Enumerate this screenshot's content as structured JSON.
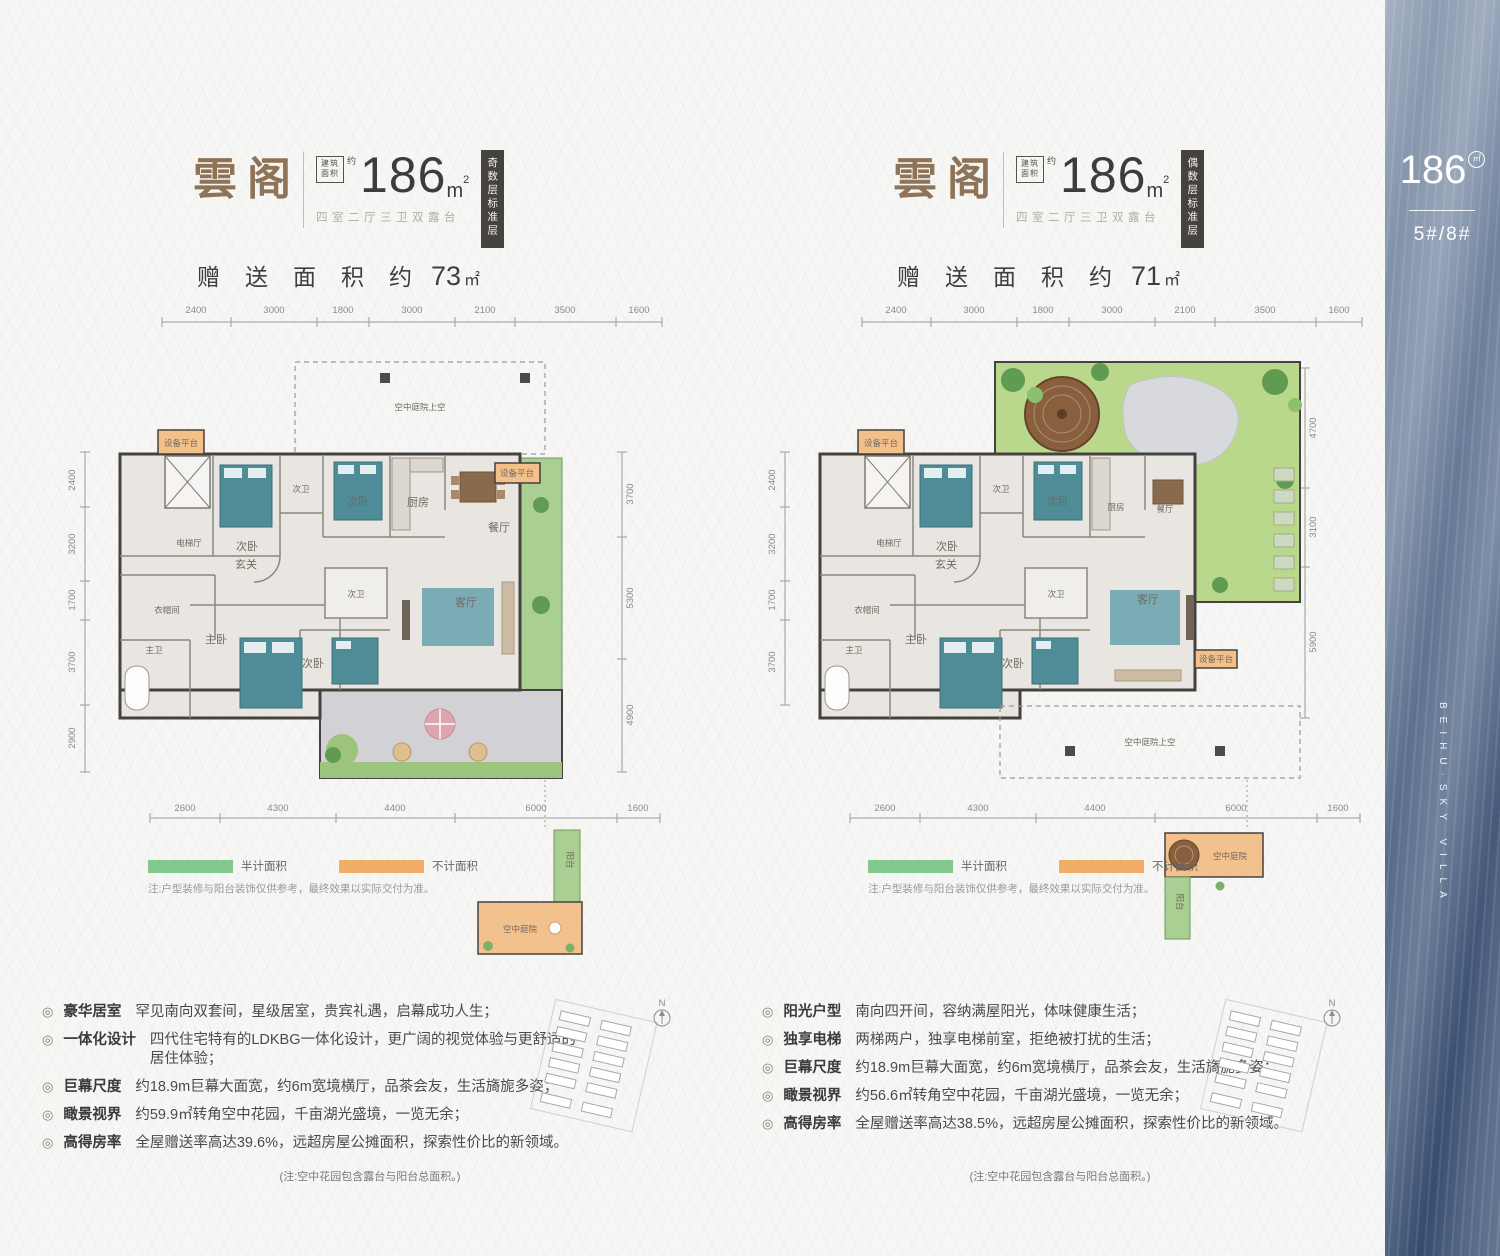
{
  "colors": {
    "title_brown": "#8f7356",
    "badge_dark": "#46423d",
    "legend_green": "#82c98f",
    "legend_orange": "#f2ae67",
    "plan_green": "#aacf92",
    "plan_orange": "#f4c089",
    "bed_teal": "#4e8d98",
    "sidebar_blue": "#6d809d"
  },
  "left": {
    "header": {
      "title": "雲阁",
      "area_box": "建筑面积",
      "approx": "约",
      "area": "186",
      "area_unit_m": "m",
      "area_sup": "2",
      "subtitle": "四室二厅三卫双露台",
      "bonus_label": "赠送面积约",
      "bonus_value": "73",
      "bonus_unit": "㎡",
      "floor_badge": "奇数层标准层"
    },
    "plan": {
      "dims_top": [
        "2400",
        "3000",
        "1800",
        "3000",
        "2100",
        "3500",
        "1600"
      ],
      "dims_left": [
        "2400",
        "3200",
        "1700",
        "3700",
        "2900"
      ],
      "dims_right": [
        "3700",
        "5300",
        "4900"
      ],
      "dims_bottom": [
        "2600",
        "4300",
        "4400",
        "6000",
        "1600"
      ],
      "void_label": "空中庭院上空",
      "rooms": [
        "设备平台",
        "次卧",
        "次卫",
        "次卧",
        "厨房",
        "餐厅",
        "设备平台",
        "电梯厅",
        "玄关",
        "衣帽间",
        "主卫",
        "主卧",
        "次卫",
        "次卧",
        "客厅"
      ],
      "inset_terrace": "空中庭院",
      "inset_balcony": "阳台"
    },
    "legend": {
      "half": "半计面积",
      "excluded": "不计面积",
      "note": "注:户型装修与阳台装饰仅供参考，最终效果以实际交付为准。"
    },
    "features": [
      {
        "title": "豪华居室",
        "desc": "罕见南向双套间，星级居室，贵宾礼遇，启幕成功人生；"
      },
      {
        "title": "一体化设计",
        "desc": "四代住宅特有的LDKBG一体化设计，更广阔的视觉体验与更舒适的居住体验；"
      },
      {
        "title": "巨幕尺度",
        "desc": "约18.9m巨幕大面宽，约6m宽境横厅，品茶会友，生活旖旎多姿；"
      },
      {
        "title": "瞰景视界",
        "desc": "约59.9㎡转角空中花园，千亩湖光盛境，一览无余；"
      },
      {
        "title": "高得房率",
        "desc": "全屋赠送率高达39.6%，远超房屋公摊面积，探索性价比的新领域。"
      }
    ],
    "footnote": "(注:空中花园包含露台与阳台总面积。)",
    "compass": "N"
  },
  "right": {
    "header": {
      "title": "雲阁",
      "area_box": "建筑面积",
      "approx": "约",
      "area": "186",
      "area_unit_m": "m",
      "area_sup": "2",
      "subtitle": "四室二厅三卫双露台",
      "bonus_label": "赠送面积约",
      "bonus_value": "71",
      "bonus_unit": "㎡",
      "floor_badge": "偶数层标准层"
    },
    "plan": {
      "dims_top": [
        "2400",
        "3000",
        "1800",
        "3000",
        "2100",
        "3500",
        "1600"
      ],
      "dims_left": [
        "2400",
        "3200",
        "1700",
        "3700"
      ],
      "dims_right": [
        "4700",
        "3100",
        "5900"
      ],
      "dims_bottom": [
        "2600",
        "4300",
        "4400",
        "6000",
        "1600"
      ],
      "void_label": "空中庭院上空",
      "rooms": [
        "设备平台",
        "次卧",
        "次卫",
        "次卧",
        "厨房",
        "餐厅",
        "设备平台",
        "电梯厅",
        "玄关",
        "衣帽间",
        "主卫",
        "主卧",
        "次卫",
        "次卧",
        "客厅"
      ],
      "inset_terrace": "空中庭院",
      "inset_balcony": "阳台"
    },
    "legend": {
      "half": "半计面积",
      "excluded": "不计面积",
      "note": "注:户型装修与阳台装饰仅供参考，最终效果以实际交付为准。"
    },
    "features": [
      {
        "title": "阳光户型",
        "desc": "南向四开间，容纳满屋阳光，体味健康生活；"
      },
      {
        "title": "独享电梯",
        "desc": "两梯两户，独享电梯前室，拒绝被打扰的生活；"
      },
      {
        "title": "巨幕尺度",
        "desc": "约18.9m巨幕大面宽，约6m宽境横厅，品茶会友，生活旖旎多姿；"
      },
      {
        "title": "瞰景视界",
        "desc": "约56.6㎡转角空中花园，千亩湖光盛境，一览无余；"
      },
      {
        "title": "高得房率",
        "desc": "全屋赠送率高达38.5%，远超房屋公摊面积，探索性价比的新领域。"
      }
    ],
    "footnote": "(注:空中花园包含露台与阳台总面积。)",
    "compass": "N"
  },
  "sidebar": {
    "area": "186",
    "unit": "㎡",
    "buildings": "5#/8#",
    "slogan": "湖境·学府一雲墅",
    "slogan_en": "BEIHU·SKY VILLA"
  }
}
